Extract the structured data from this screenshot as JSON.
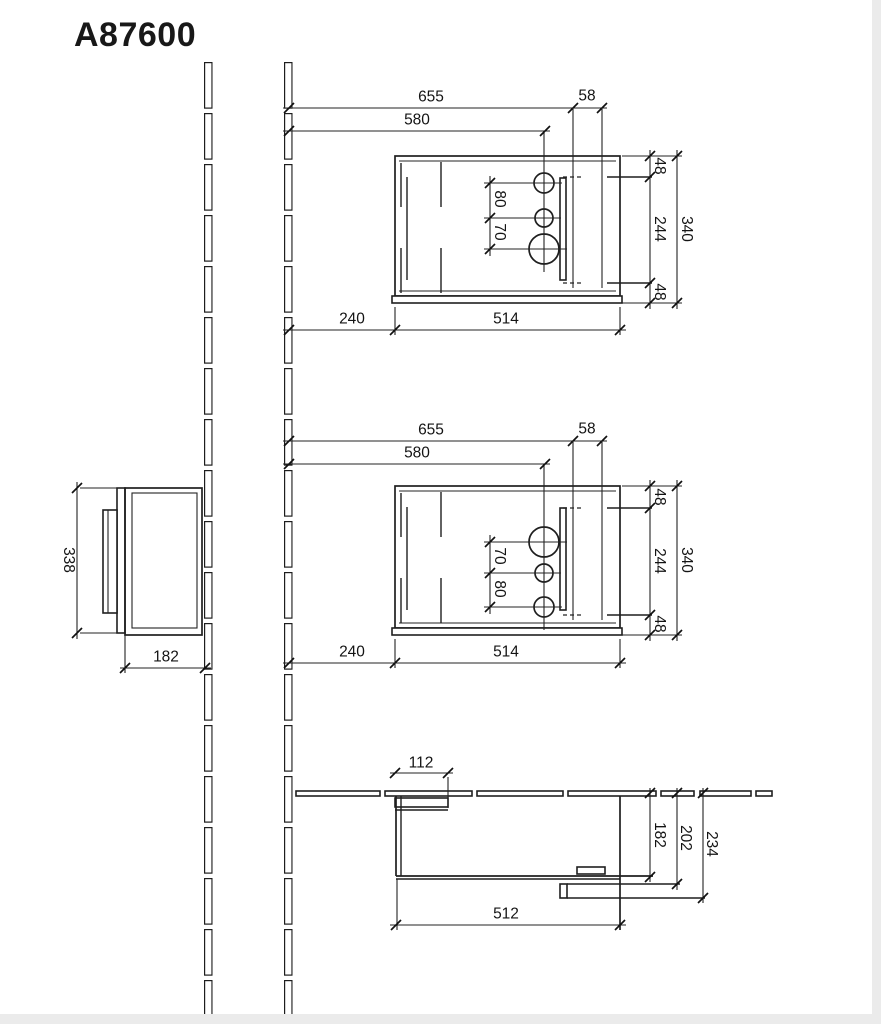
{
  "title": "A87600",
  "views": {
    "front_top": {
      "dims": {
        "overall_width": "655",
        "fixing_offset": "58",
        "tap_center": "580",
        "edge_top": "48",
        "fixing_span": "244",
        "edge_bottom": "48",
        "height": "340",
        "hole_gap_upper": "80",
        "hole_gap_lower": "70",
        "wall_gap": "240",
        "body_width": "514"
      }
    },
    "front_middle": {
      "dims": {
        "overall_width": "655",
        "fixing_offset": "58",
        "tap_center": "580",
        "edge_top": "48",
        "fixing_span": "244",
        "edge_bottom": "48",
        "height": "340",
        "hole_gap_upper": "70",
        "hole_gap_lower": "80",
        "wall_gap": "240",
        "body_width": "514"
      }
    },
    "side": {
      "dims": {
        "height": "338",
        "depth": "182"
      }
    },
    "plan": {
      "dims": {
        "flap_width": "112",
        "carcass_depth": "182",
        "front_depth": "202",
        "overall_depth": "234",
        "body_width": "512"
      }
    }
  }
}
